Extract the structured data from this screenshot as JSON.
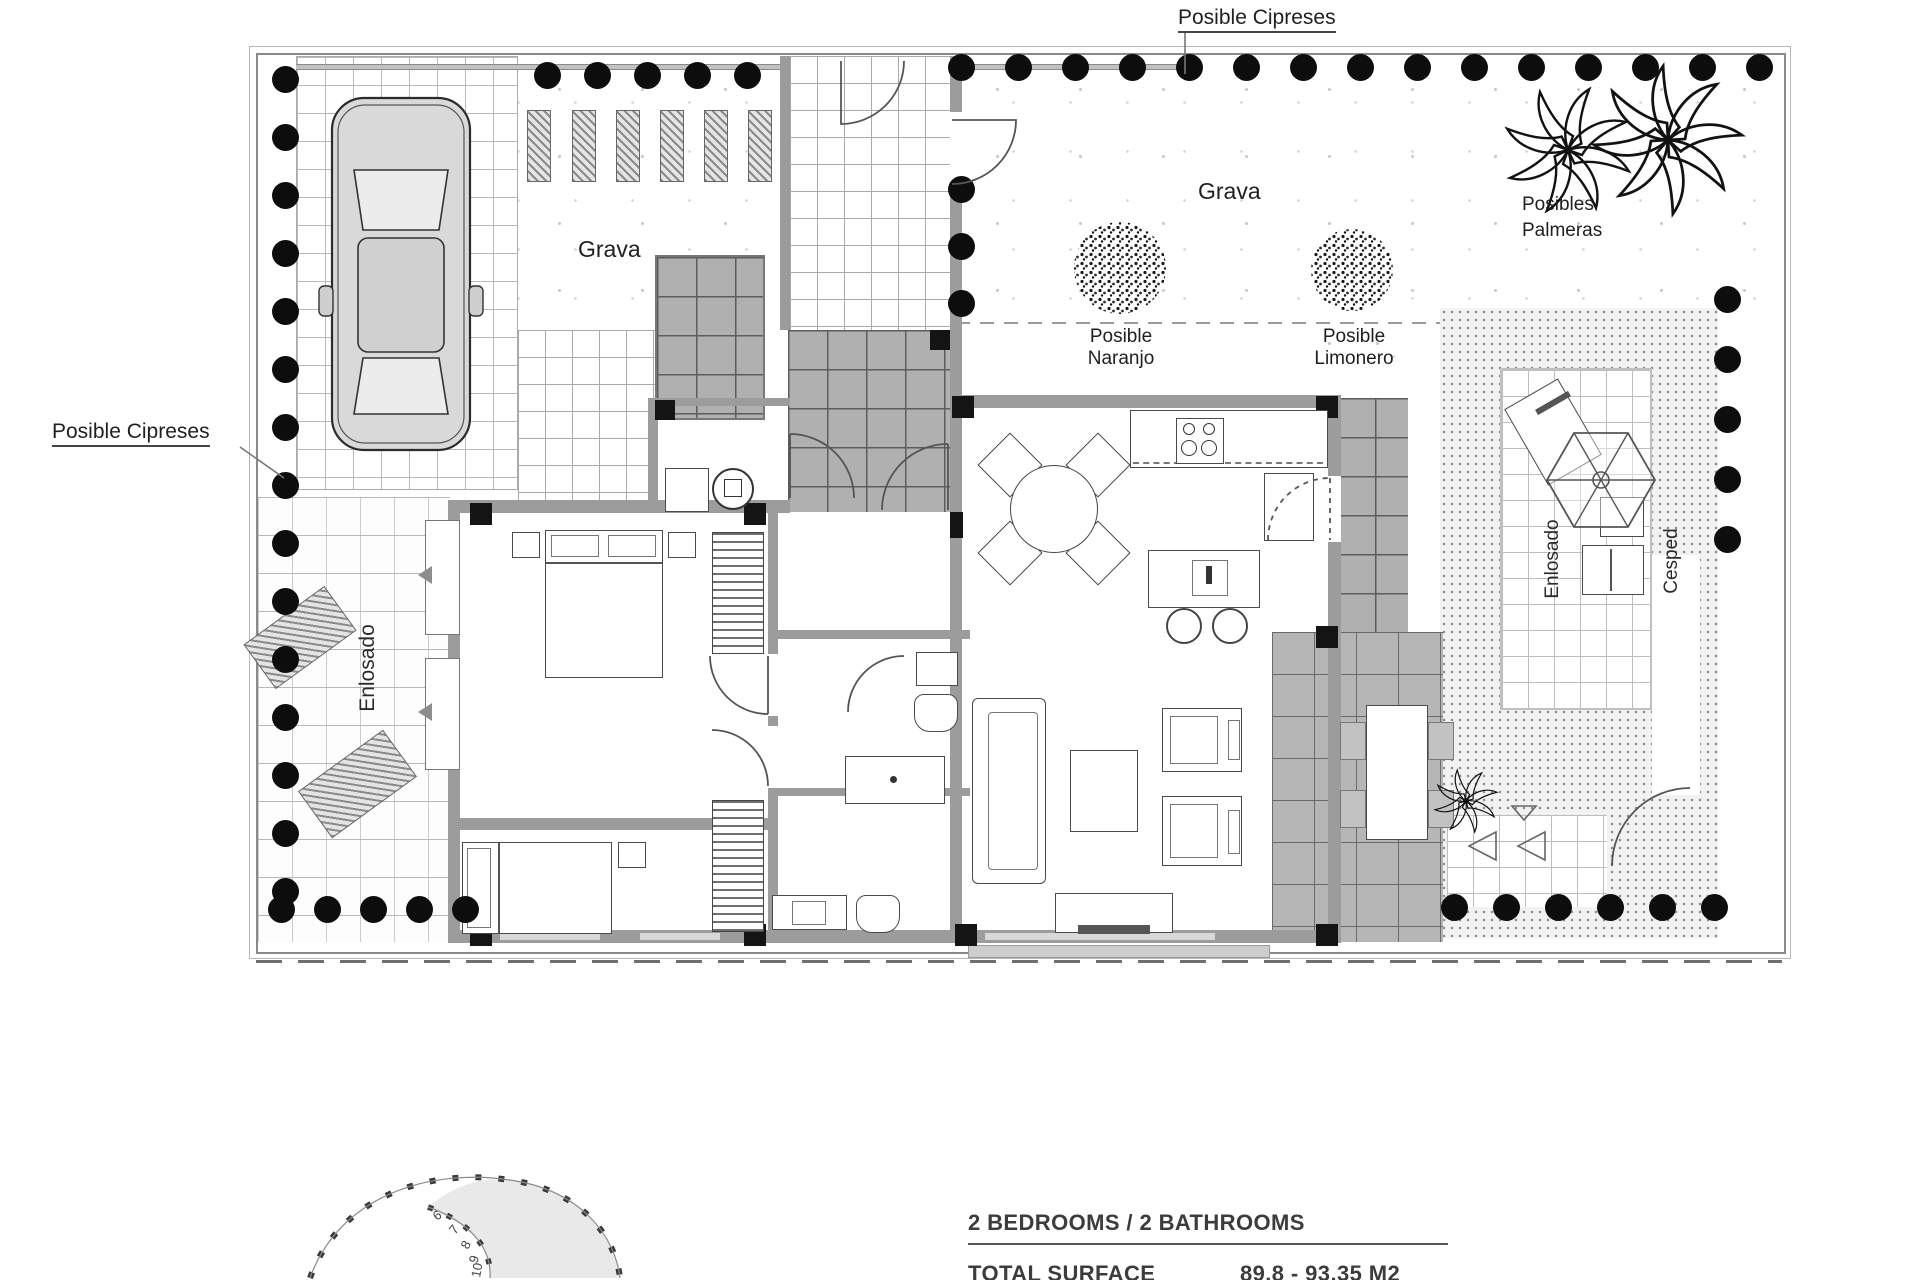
{
  "labels": {
    "cipreses_top": "Posible Cipreses",
    "cipreses_left": "Posible Cipreses",
    "grava_left": "Grava",
    "grava_right": "Grava",
    "naranjo_1": "Posible",
    "naranjo_2": "Naranjo",
    "limonero_1": "Posible",
    "limonero_2": "Limonero",
    "palmeras_1": "Posibles",
    "palmeras_2": "Palmeras",
    "enlosado_left": "Enlosado",
    "enlosado_patio": "Enlosado",
    "cesped": "Cesped"
  },
  "summary": {
    "rooms": "2 BEDROOMS / 2 BATHROOMS",
    "total_surface_label": "TOTAL SURFACE",
    "total_surface_value": "89.8 - 93.35 M2"
  },
  "sun_path": {
    "hours": [
      "6",
      "7",
      "8",
      "9",
      "10"
    ]
  },
  "cypress_rows": [
    {
      "x": 272,
      "y": 66,
      "dx": 0,
      "dy": 58,
      "count": 15
    },
    {
      "x": 534,
      "y": 62,
      "dx": 50,
      "dy": 0,
      "count": 5
    },
    {
      "x": 948,
      "y": 54,
      "dx": 57,
      "dy": 0,
      "count": 15
    },
    {
      "x": 948,
      "y": 176,
      "dx": 0,
      "dy": 57,
      "count": 3
    },
    {
      "x": 1714,
      "y": 286,
      "dx": 0,
      "dy": 60,
      "count": 5
    },
    {
      "x": 1441,
      "y": 894,
      "dx": 52,
      "dy": 0,
      "count": 6
    },
    {
      "x": 268,
      "y": 896,
      "dx": 46,
      "dy": 0,
      "count": 5
    }
  ],
  "colors": {
    "tree_dot": "#0d0d0d",
    "wall_gray": "#9c9c9c",
    "dark_tile": "#b0b0b0",
    "line": "#4a4a4a"
  }
}
